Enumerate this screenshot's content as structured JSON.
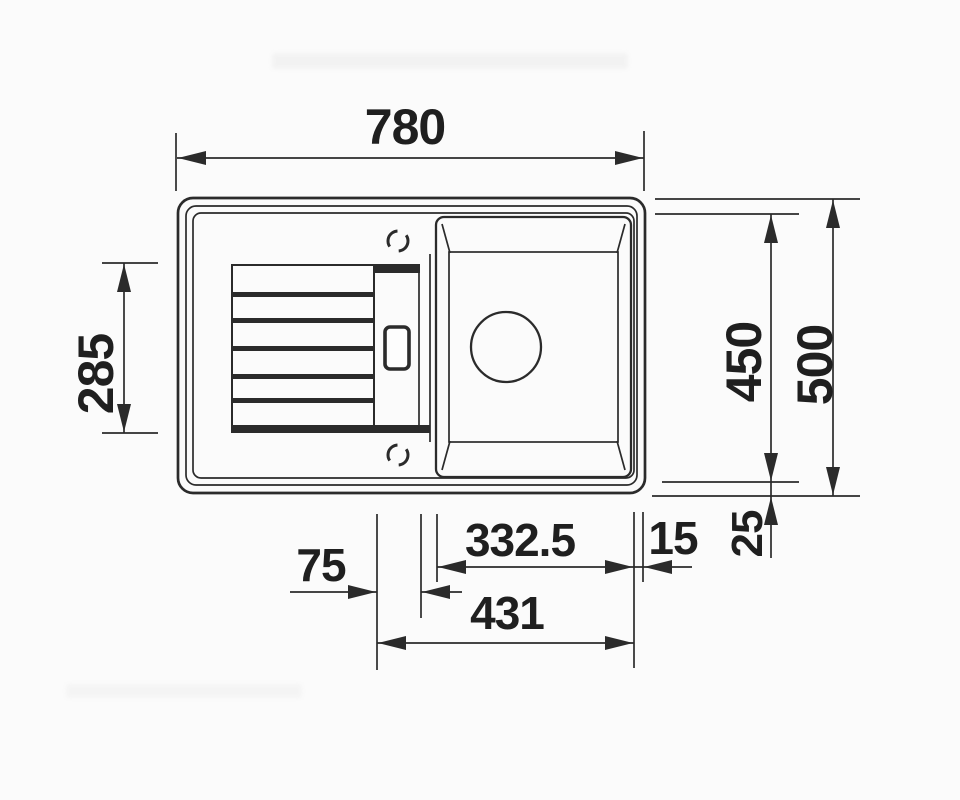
{
  "drawing": {
    "type": "sink-top-view-technical-drawing",
    "description_visible_elements": [
      "drainboard-with-ribs",
      "bowl",
      "drain-circle",
      "overflow-window",
      "tap-hole-markers"
    ]
  },
  "dimensions": {
    "top_width": "780",
    "left_height": "285",
    "right_inner_height": "450",
    "right_outer_height": "500",
    "bottom_rim_offset": "25",
    "bowl_width": "332.5",
    "rim_gap": "15",
    "step_width": "75",
    "bowl_overall_width": "431"
  },
  "colors": {
    "background": "#fbfbfb",
    "line": "#2b2b2b",
    "label": "#1f1f1f"
  }
}
